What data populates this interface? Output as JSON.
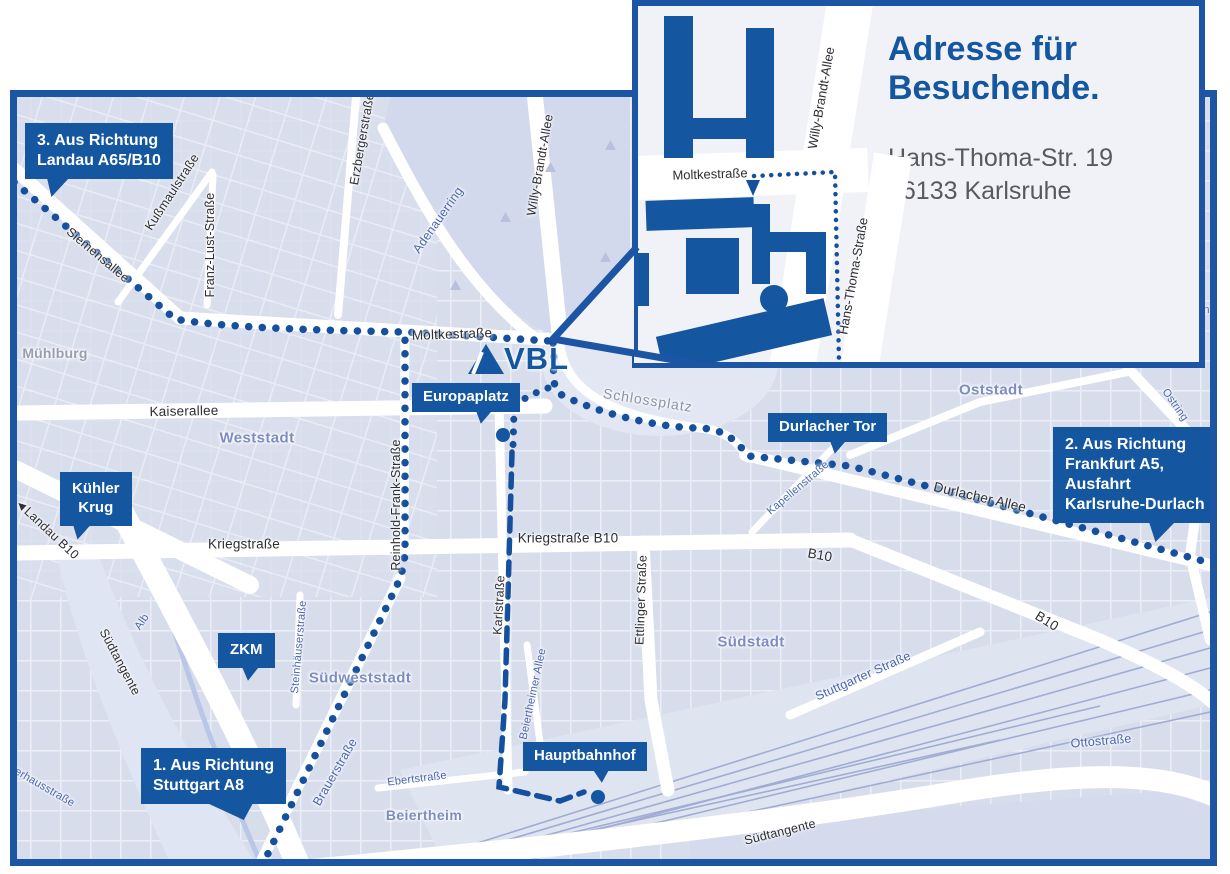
{
  "map": {
    "logo_text": "VBL",
    "districts": {
      "muehlburg": "Mühlburg",
      "weststadt": "Weststadt",
      "oststadt": "Oststadt",
      "suedstadt": "Südstadt",
      "suedweststadt": "Südweststadt",
      "beiertheim": "Beiertheim"
    },
    "pois": {
      "schlossplatz": "Schlossplatz"
    },
    "streets": {
      "siemensallee": "Siemensallee",
      "kussmaulstrasse": "Kußmaulstraße",
      "franz_lust_strasse": "Franz-Lust-Straße",
      "erzbergerstrasse": "Erzbergerstraße",
      "adenauerring": "Adenauerring",
      "willy_brandt_allee": "Willy-Brandt-Allee",
      "moltkestrasse": "Moltkestraße",
      "kaiserallee": "Kaiserallee",
      "kriegstrasse": "Kriegstraße",
      "kriegstrasse_b10": "Kriegstraße B10",
      "b10_mid": "B10",
      "b10_east": "B10",
      "reinhold_frank_strasse": "Reinhold-Frank-Straße",
      "karlstrasse": "Karlstraße",
      "ettlinger_strasse": "Ettlinger Straße",
      "steinhaeuserstrasse": "Steinhäuserstraße",
      "brauerstrasse": "Brauerstraße",
      "ebertstrasse": "Ebertstraße",
      "beiertheimer_allee": "Beiertheimer Allee",
      "durlacher_allee": "Durlacher Allee",
      "kapellenstrasse": "Kapellenstraße",
      "ostring_north": "Ostring",
      "ostring_south": "Ostring",
      "stuttgarter_strasse": "Stuttgarter Straße",
      "ottostrasse": "Ottostraße",
      "suedtangente_west": "Südtangente",
      "suedtangente_south": "Südtangente",
      "alb": "Alb",
      "landau_arrow": "◄",
      "landau_b10": "Landau B10",
      "verhausstrasse_partial": "verhausstraße",
      "ein_partial": "ein"
    },
    "callouts": {
      "landau": {
        "lines": [
          "3. Aus Richtung",
          "Landau A65/B10"
        ]
      },
      "kuehler_krug": {
        "lines": [
          "Kühler",
          "Krug"
        ]
      },
      "zkm": {
        "lines": [
          "ZKM"
        ]
      },
      "stuttgart": {
        "lines": [
          "1. Aus Richtung",
          "Stuttgart A8"
        ]
      },
      "europaplatz": {
        "lines": [
          "Europaplatz"
        ]
      },
      "durlacher_tor": {
        "lines": [
          "Durlacher Tor"
        ]
      },
      "frankfurt": {
        "lines": [
          "2. Aus Richtung",
          "Frankfurt A5,",
          "Ausfahrt",
          "Karlsruhe-Durlach"
        ]
      },
      "hauptbahnhof": {
        "lines": [
          "Hauptbahnhof"
        ]
      }
    }
  },
  "inset": {
    "title_lines": [
      "Adresse für",
      "Besuchende."
    ],
    "address_lines": [
      "Hans-Thoma-Str. 19",
      "76133 Karlsruhe"
    ],
    "streets": {
      "moltkestrasse": "Moltkestraße",
      "willy_brandt_allee": "Willy-Brandt-Allee",
      "hans_thoma_strasse": "Hans-Thoma-Straße"
    }
  },
  "colors": {
    "primary_blue": "#1456a0",
    "border_blue": "#1d55a5",
    "map_bg": "#dde2ef",
    "panel_bg": "#f1f2f8",
    "text_gray": "#58595b"
  }
}
